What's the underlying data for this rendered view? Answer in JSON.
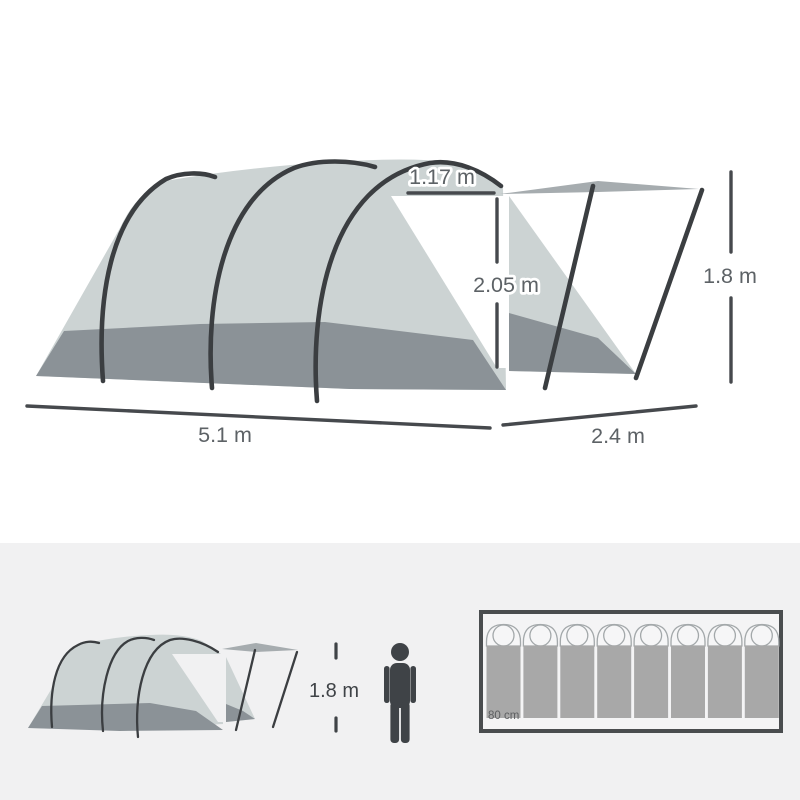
{
  "diagram": {
    "door_width_label": "1.17 m",
    "door_height_label": "2.05 m",
    "porch_height_label": "1.8 m",
    "tent_length_label": "5.1 m",
    "porch_depth_label": "2.4 m"
  },
  "scale_figure": {
    "person_height_label": "1.8 m"
  },
  "floorplan": {
    "bag_width_label": "80 cm",
    "sleeping_bag_count": 8
  },
  "colors": {
    "canvas_light": "#ccd3d3",
    "canvas_dark": "#8b9297",
    "pole_dark": "#3b3e41",
    "canopy_gray": "#a6acaf",
    "dimension_text": "#5d6266",
    "panel_background": "#f1f1f2",
    "figure_dark": "#3f4347",
    "sleeping_bag_gray": "#a8a8a8",
    "floorplan_border": "#4a4d4f"
  },
  "icons": {
    "person": "person-icon",
    "sleeping_bag": "sleeping-bag-icon",
    "tent": "tent-icon"
  }
}
